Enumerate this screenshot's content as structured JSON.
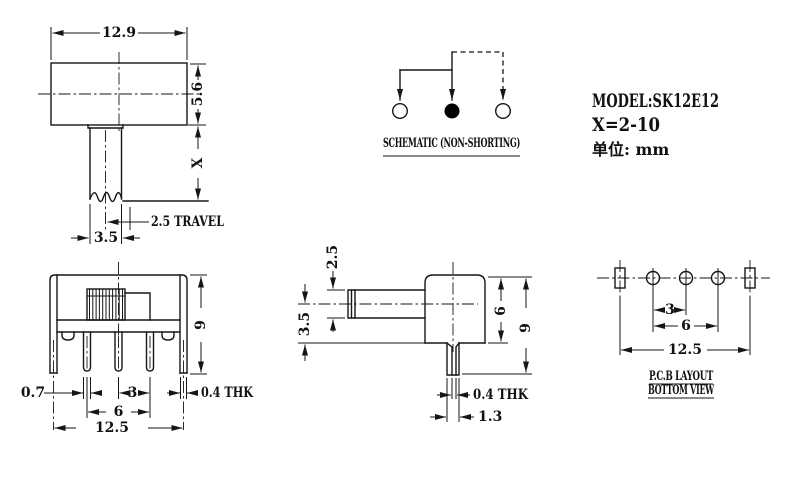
{
  "colors": {
    "background": "#ffffff",
    "line": "#161616",
    "contact_fill": "#000000"
  },
  "title_block": {
    "model": "MODEL:SK12E12",
    "x_range": "X=2-10",
    "unit_label": "单位: mm"
  },
  "schematic": {
    "caption": "SCHEMATIC (NON-SHORTING)"
  },
  "top_view": {
    "dim_width": "12.9",
    "dim_cap_height": "5.6",
    "dim_stem_length": "X",
    "dim_travel": "2.5 TRAVEL",
    "dim_stem_width": "3.5"
  },
  "front_view": {
    "dim_pin_width": "0.7",
    "dim_pin_pitch": "3",
    "dim_pin_span": "6",
    "dim_total_width": "12.5",
    "dim_height": "9",
    "dim_bracket_thk": "0.4 THK"
  },
  "side_view": {
    "dim_stem_thk": "2.5",
    "dim_stem_center": "3.5",
    "dim_body_height": "6",
    "dim_total_height": "9",
    "dim_pin_thk": "0.4 THK",
    "dim_pin_width": "1.3"
  },
  "pcb_layout": {
    "caption_line1": "P.C.B LAYOUT",
    "caption_line2": "BOTTOM VIEW",
    "dim_pitch": "3",
    "dim_span": "6",
    "dim_total": "12.5"
  }
}
